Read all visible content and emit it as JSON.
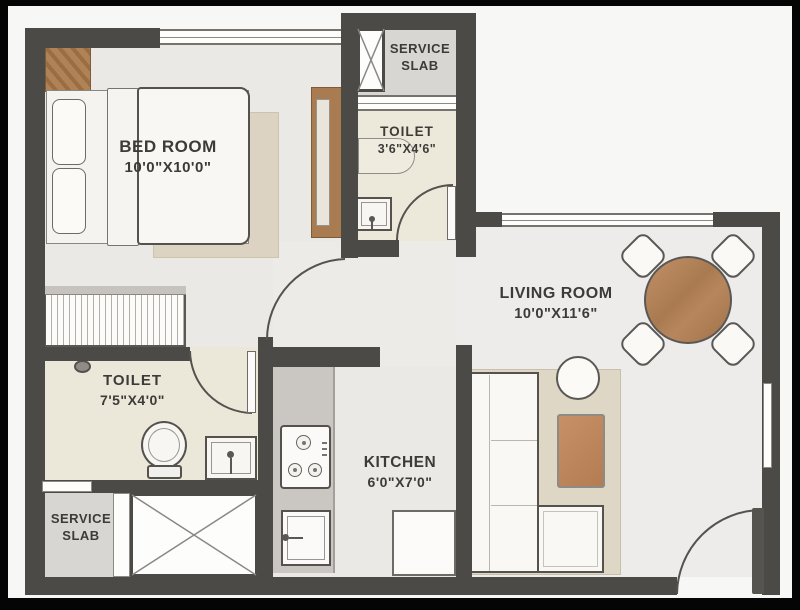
{
  "plan_type": "apartment-floor-plan",
  "rooms": {
    "bedroom": {
      "name": "BED ROOM",
      "dims": "10'0\"X10'0\""
    },
    "toilet_top": {
      "name": "TOILET",
      "dims": "3'6\"X4'6\""
    },
    "living": {
      "name": "LIVING ROOM",
      "dims": "10'0\"X11'6\""
    },
    "toilet_bottom": {
      "name": "TOILET",
      "dims": "7'5\"X4'0\""
    },
    "kitchen": {
      "name": "KITCHEN",
      "dims": "6'0\"X7'0\""
    },
    "service_top": {
      "line1": "SERVICE",
      "line2": "SLAB"
    },
    "service_bottom": {
      "line1": "SERVICE",
      "line2": "SLAB"
    }
  },
  "icons": {
    "shower_head": "shower-head-icon",
    "stove_burners": "gas-burner-icon",
    "tap": "tap-icon",
    "shaft_cross": "duct-cross-icon"
  },
  "colors": {
    "wall": "#4c4a47",
    "floor_light": "#ebe9e6",
    "floor_toilet": "#ece9db",
    "floor_service": "#d7d6d3",
    "wood": "#a87c50",
    "counter_gray": "#cac7c2",
    "rug_beige": "#dcd4c3",
    "outline": "#55524e",
    "frame": "#050505",
    "text": "#3d3b38"
  }
}
